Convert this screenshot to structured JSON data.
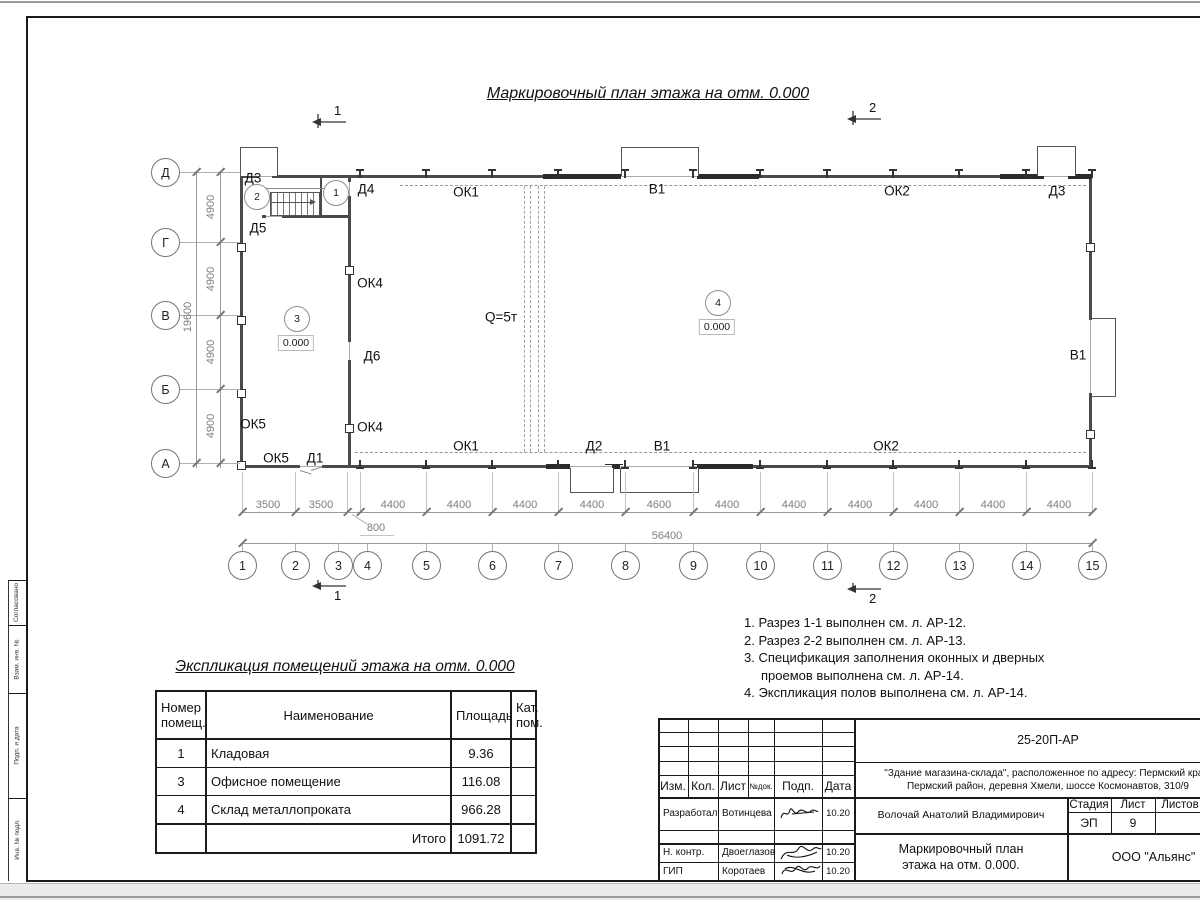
{
  "plan": {
    "title": "Маркировочный план этажа на отм. 0.000",
    "crane_label": "Q=5т"
  },
  "axes": {
    "rows": [
      {
        "label": "Д",
        "y": 172
      },
      {
        "label": "Г",
        "y": 242
      },
      {
        "label": "В",
        "y": 315
      },
      {
        "label": "Б",
        "y": 389
      },
      {
        "label": "А",
        "y": 463
      }
    ],
    "cols": [
      {
        "label": "1",
        "x": 242,
        "ax": 242
      },
      {
        "label": "2",
        "x": 295,
        "ax": 295
      },
      {
        "label": "3",
        "x": 338,
        "ax": 347
      },
      {
        "label": "4",
        "x": 367,
        "ax": 360
      },
      {
        "label": "5",
        "x": 426,
        "ax": 426
      },
      {
        "label": "6",
        "x": 492,
        "ax": 492
      },
      {
        "label": "7",
        "x": 558,
        "ax": 558
      },
      {
        "label": "8",
        "x": 625,
        "ax": 625
      },
      {
        "label": "9",
        "x": 693,
        "ax": 693
      },
      {
        "label": "10",
        "x": 760,
        "ax": 760
      },
      {
        "label": "11",
        "x": 827,
        "ax": 827
      },
      {
        "label": "12",
        "x": 893,
        "ax": 893
      },
      {
        "label": "13",
        "x": 959,
        "ax": 959
      },
      {
        "label": "14",
        "x": 1026,
        "ax": 1026
      },
      {
        "label": "15",
        "x": 1092,
        "ax": 1092
      }
    ],
    "row_dims": [
      {
        "text": "4900",
        "y": 207
      },
      {
        "text": "4900",
        "y": 279
      },
      {
        "text": "4900",
        "y": 352
      },
      {
        "text": "4900",
        "y": 426
      }
    ],
    "row_total": {
      "text": "19600",
      "y": 317
    },
    "col_dims": [
      {
        "text": "3500",
        "x": 268
      },
      {
        "text": "3500",
        "x": 321
      },
      {
        "text": "4400",
        "x": 393
      },
      {
        "text": "4400",
        "x": 459
      },
      {
        "text": "4400",
        "x": 525
      },
      {
        "text": "4400",
        "x": 592
      },
      {
        "text": "4600",
        "x": 659
      },
      {
        "text": "4400",
        "x": 727
      },
      {
        "text": "4400",
        "x": 794
      },
      {
        "text": "4400",
        "x": 860
      },
      {
        "text": "4400",
        "x": 926
      },
      {
        "text": "4400",
        "x": 993
      },
      {
        "text": "4400",
        "x": 1059
      }
    ],
    "col_offset_dim": {
      "text": "800",
      "x": 376,
      "y": 528
    },
    "col_total": {
      "text": "56400",
      "x": 667,
      "y": 536
    }
  },
  "plan_labels": [
    {
      "text": "Д3",
      "x": 253,
      "y": 178
    },
    {
      "text": "Д4",
      "x": 366,
      "y": 189
    },
    {
      "text": "ОК1",
      "x": 466,
      "y": 192
    },
    {
      "text": "В1",
      "x": 657,
      "y": 189
    },
    {
      "text": "ОК2",
      "x": 897,
      "y": 191
    },
    {
      "text": "Д3",
      "x": 1057,
      "y": 191
    },
    {
      "text": "Д5",
      "x": 258,
      "y": 228
    },
    {
      "text": "ОК4",
      "x": 370,
      "y": 283
    },
    {
      "text": "Д6",
      "x": 372,
      "y": 356
    },
    {
      "text": "ОК5",
      "x": 253,
      "y": 424
    },
    {
      "text": "ОК5",
      "x": 276,
      "y": 458
    },
    {
      "text": "Д1",
      "x": 315,
      "y": 458
    },
    {
      "text": "ОК4",
      "x": 370,
      "y": 427
    },
    {
      "text": "ОК1",
      "x": 466,
      "y": 446
    },
    {
      "text": "Д2",
      "x": 594,
      "y": 446
    },
    {
      "text": "В1",
      "x": 662,
      "y": 446
    },
    {
      "text": "ОК2",
      "x": 886,
      "y": 446
    },
    {
      "text": "В1",
      "x": 1078,
      "y": 355
    },
    {
      "text": "Q=5т",
      "x": 501,
      "y": 317
    }
  ],
  "room_markers": [
    {
      "num": "2",
      "x": 256,
      "y": 196,
      "elev": ""
    },
    {
      "num": "1",
      "x": 335,
      "y": 192,
      "elev": ""
    },
    {
      "num": "3",
      "x": 296,
      "y": 318,
      "elev": "0.000"
    },
    {
      "num": "4",
      "x": 717,
      "y": 302,
      "elev": "0.000"
    }
  ],
  "section_marks": [
    {
      "num": "1",
      "x": 318,
      "y": 120,
      "pos": "top"
    },
    {
      "num": "2",
      "x": 853,
      "y": 117,
      "pos": "top"
    },
    {
      "num": "1",
      "x": 318,
      "y": 586,
      "pos": "bottom"
    },
    {
      "num": "2",
      "x": 853,
      "y": 589,
      "pos": "bottom"
    }
  ],
  "explication": {
    "title": "Экспликация помещений этажа на отм. 0.000",
    "headers": [
      "Номер помещ.",
      "Наименование",
      "Площадь",
      "Кат. пом."
    ],
    "rows": [
      {
        "num": "1",
        "name": "Кладовая",
        "area": "9.36",
        "cat": ""
      },
      {
        "num": "3",
        "name": "Офисное помещение",
        "area": "116.08",
        "cat": ""
      },
      {
        "num": "4",
        "name": "Склад металлопроката",
        "area": "966.28",
        "cat": ""
      }
    ],
    "total_label": "Итого",
    "total_value": "1091.72"
  },
  "notes": [
    "1. Разрез 1-1 выполнен см. л. АР-12.",
    "2. Разрез 2-2 выполнен см. л. АР-13.",
    "3. Спецификация заполнения оконных и дверных проемов выполнена см. л. АР-14.",
    "4. Экспликация полов выполнена см. л. АР-14."
  ],
  "titleblock": {
    "doc_number": "25-20П-АР",
    "object_line1": "\"Здание магазина-склада\", расположенное по адресу: Пермский край,",
    "object_line2": "Пермский район, деревня Хмели, шоссе Космонавтов, 310/9",
    "header_cols": [
      "Изм.",
      "Кол.",
      "Лист",
      "№док.",
      "Подп.",
      "Дата"
    ],
    "person_name": "Волочай Анатолий Владимирович",
    "drawing_name_line1": "Маркировочный план",
    "drawing_name_line2": "этажа на отм. 0.000.",
    "stage_header": "Стадия",
    "sheet_header": "Лист",
    "sheets_header": "Листов",
    "stage_value": "ЭП",
    "sheet_value": "9",
    "company": "ООО \"Альянс\"",
    "roles": [
      {
        "role": "Разработал",
        "name": "Вотинцева",
        "date": "10.20"
      },
      {
        "role": "Н. контр.",
        "name": "Двоеглазов",
        "date": "10.20"
      },
      {
        "role": "ГИП",
        "name": "Коротаев",
        "date": "10.20"
      }
    ]
  },
  "frame_labels": [
    "Согласовано",
    "Взам. инв. №",
    "Подп. и дата",
    "Инв. № подл."
  ]
}
